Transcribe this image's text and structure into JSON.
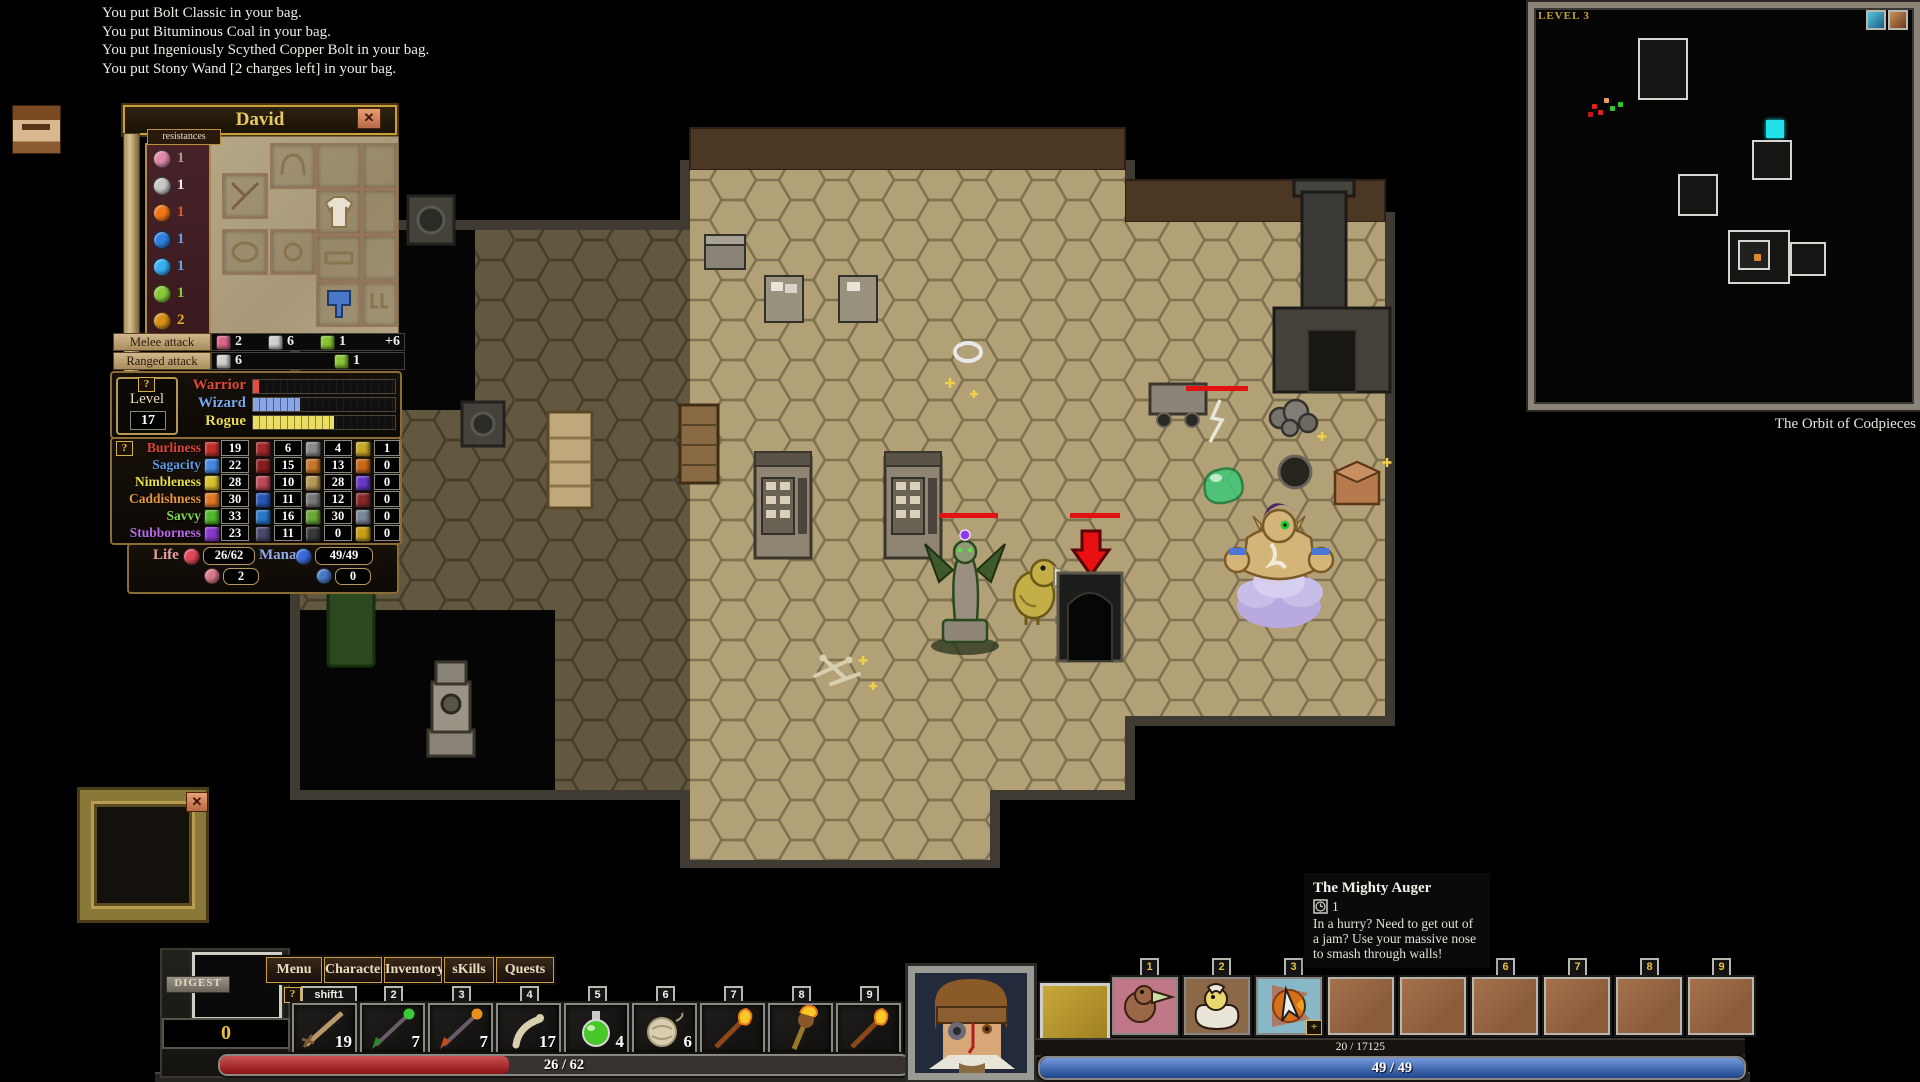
{
  "message_log": {
    "lines": [
      "You put Bolt Classic in your bag.",
      "You put Bituminous Coal in your bag.",
      "You put Ingeniously Scythed Copper Bolt in your bag.",
      "You put Stony Wand [2 charges left] in your bag."
    ]
  },
  "character_panel": {
    "title": "David",
    "close_label": "✕",
    "resistances": {
      "label": "resistances",
      "items": [
        {
          "icon": "righteous-resist-icon",
          "color": "#e08aa8",
          "value": "1",
          "value_color": "#a89a90"
        },
        {
          "icon": "piercing-resist-icon",
          "color": "#c8c8c8",
          "value": "1",
          "value_color": "#f0ede4"
        },
        {
          "icon": "conflagratory-resist-icon",
          "color": "#f07818",
          "value": "1",
          "value_color": "#e05828"
        },
        {
          "icon": "hyperborean-resist-icon",
          "color": "#2f7fe0",
          "value": "1",
          "value_color": "#6a9ae8"
        },
        {
          "icon": "voltaic-resist-icon",
          "color": "#38b0f0",
          "value": "1",
          "value_color": "#5aa8e8"
        },
        {
          "icon": "acidic-resist-icon",
          "color": "#8ac83a",
          "value": "1",
          "value_color": "#88c838"
        },
        {
          "icon": "transmutative-resist-icon",
          "color": "#d89018",
          "value": "2",
          "value_color": "#e8a828"
        }
      ]
    },
    "melee_attack": {
      "label": "Melee attack",
      "entries": [
        {
          "icon": "crushing-damage-icon",
          "color": "#d8688a",
          "value": "2"
        },
        {
          "icon": "piercing-damage-icon",
          "color": "#d0d0d0",
          "value": "6"
        },
        {
          "icon": "acidic-damage-icon",
          "color": "#88c434",
          "value": "1"
        }
      ],
      "bonus": "+6"
    },
    "ranged_attack": {
      "label": "Ranged attack",
      "entries": [
        {
          "icon": "piercing-damage-icon",
          "color": "#d0d0d0",
          "value": "6"
        },
        {
          "icon": "acidic-damage-icon",
          "color": "#88c434",
          "value": "1"
        }
      ]
    },
    "level_box": {
      "help_label": "?",
      "label": "Level",
      "value": "17"
    },
    "classes": [
      {
        "name": "Warrior",
        "color": "#e04838",
        "fill": "#e03020",
        "progress": "4%"
      },
      {
        "name": "Wizard",
        "color": "#78a8e8",
        "fill": "#7898e0",
        "progress": "33%"
      },
      {
        "name": "Rogue",
        "color": "#e8d84a",
        "fill": "#e8d848",
        "progress": "57%"
      }
    ],
    "stats": {
      "help_label": "?",
      "rows": [
        {
          "name": "Burliness",
          "color": "#e04438",
          "icon_color": "#c03028",
          "value": "19"
        },
        {
          "name": "Sagacity",
          "color": "#5a9ae8",
          "icon_color": "#4888e0",
          "value": "22"
        },
        {
          "name": "Nimbleness",
          "color": "#e8e04a",
          "icon_color": "#d8c030",
          "value": "28"
        },
        {
          "name": "Caddishness",
          "color": "#e8953c",
          "icon_color": "#e07828",
          "value": "30"
        },
        {
          "name": "Savvy",
          "color": "#7cd84e",
          "icon_color": "#50b82c",
          "value": "33"
        },
        {
          "name": "Stubborness",
          "color": "#b86ae8",
          "icon_color": "#8838c8",
          "value": "23"
        }
      ]
    },
    "secondary_stats": {
      "columns": [
        {
          "cells": [
            {
              "color": "#a02828",
              "value": "6"
            },
            {
              "color": "#881e1e",
              "value": "15"
            },
            {
              "color": "#c04858",
              "value": "10"
            },
            {
              "color": "#2858b8",
              "value": "11"
            },
            {
              "color": "#2878c8",
              "value": "16"
            },
            {
              "color": "#48486a",
              "value": "11"
            }
          ]
        },
        {
          "cells": [
            {
              "color": "#8a8a8a",
              "value": "4"
            },
            {
              "color": "#c87828",
              "value": "13"
            },
            {
              "color": "#b89858",
              "value": "28"
            },
            {
              "color": "#787878",
              "value": "12"
            },
            {
              "color": "#68a838",
              "value": "30"
            },
            {
              "color": "#3a3a3a",
              "value": "0"
            }
          ]
        },
        {
          "cells": [
            {
              "color": "#c8a828",
              "value": "1"
            },
            {
              "color": "#c86818",
              "value": "0"
            },
            {
              "color": "#6838c8",
              "value": "0"
            },
            {
              "color": "#8a2828",
              "value": "0"
            },
            {
              "color": "#788898",
              "value": "0"
            },
            {
              "color": "#c8a018",
              "value": "0"
            }
          ]
        }
      ]
    },
    "life_mana": {
      "life_label": "Life",
      "life_value": "26/62",
      "life_regen": "2",
      "mana_label": "Mana",
      "mana_value": "49/49",
      "mana_regen": "0"
    }
  },
  "minimap": {
    "level_label": "LEVEL 3",
    "caption": "The Orbit of Codpieces"
  },
  "tooltip": {
    "title": "The Mighty Auger",
    "count": "1",
    "body": "In a hurry? Need to get out of a jam? Use your massive nose to smash through walls!"
  },
  "frame": {
    "close_label": "✕"
  },
  "hud": {
    "digest": {
      "label": "DIGEST",
      "value": "0"
    },
    "buttons": [
      {
        "label": "Menu"
      },
      {
        "label": "Character"
      },
      {
        "label": "Inventory"
      },
      {
        "label": "sKills"
      },
      {
        "label": "Quests"
      }
    ],
    "belt": {
      "help_label": "?",
      "shift_tab": "shift1",
      "tabs": [
        "2",
        "3",
        "4",
        "5",
        "6",
        "7",
        "8",
        "9"
      ],
      "slots": [
        {
          "item": "wooden-bolt",
          "count": "19"
        },
        {
          "item": "green-tipped-bolt",
          "count": "7"
        },
        {
          "item": "orange-tipped-bolt",
          "count": "7"
        },
        {
          "item": "femur",
          "count": "17"
        },
        {
          "item": "green-potion",
          "count": "4"
        },
        {
          "item": "wool-ball",
          "count": "6"
        },
        {
          "item": "flaming-torch",
          "count": ""
        },
        {
          "item": "flaming-mace",
          "count": ""
        },
        {
          "item": "flaming-torch",
          "count": ""
        }
      ]
    },
    "health_bar": {
      "text": "26 / 62",
      "fill": "42%",
      "color": "#b81818"
    },
    "skills": {
      "left_tabs": [
        "1",
        "2",
        "3"
      ],
      "right_tabs": [
        "6",
        "7",
        "8",
        "9"
      ]
    },
    "xp_bar": {
      "text": "20 / 17125"
    },
    "mana_bar": {
      "text": "49 / 49",
      "fill": "100%",
      "color": "#2a62c8"
    }
  }
}
